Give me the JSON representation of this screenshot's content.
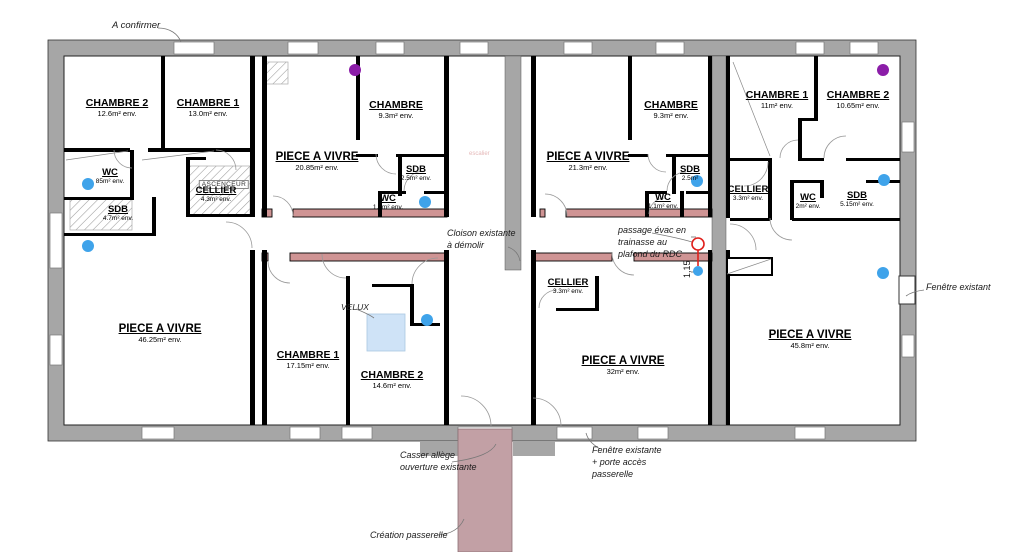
{
  "colors": {
    "wall_gray": "#a6a6a6",
    "partition_pink": "#cf9494",
    "passerelle_pink": "#c2a0a5",
    "velux_blue": "#cfe3f7",
    "dot_blue": "#3fa3ea",
    "dot_purple": "#8b1da8",
    "marker_red": "#e0201c",
    "faint_red_text": "#e5b8b8"
  },
  "rooms": [
    {
      "name": "CHAMBRE 2",
      "area": "12.6m² env."
    },
    {
      "name": "CHAMBRE 1",
      "area": "13.0m² env."
    },
    {
      "name": "WC",
      "area": "85m² env."
    },
    {
      "name": "SDB",
      "area": "4.7m² env."
    },
    {
      "name": "CELLIER",
      "area": "4.3m² env."
    },
    {
      "name": "PIECE A VIVRE",
      "area": "46.25m² env."
    },
    {
      "name": "PIECE A VIVRE",
      "area": "20.85m² env."
    },
    {
      "name": "CHAMBRE",
      "area": "9.3m² env."
    },
    {
      "name": "SDB",
      "area": "2.5m² env."
    },
    {
      "name": "WC",
      "area": "1.1m² env."
    },
    {
      "name": "CHAMBRE 1",
      "area": "17.15m² env."
    },
    {
      "name": "CHAMBRE 2",
      "area": "14.6m² env."
    },
    {
      "name": "PIECE A VIVRE",
      "area": "21.3m² env."
    },
    {
      "name": "CHAMBRE",
      "area": "9.3m² env."
    },
    {
      "name": "SDB",
      "area": "2.5m²"
    },
    {
      "name": "WC",
      "area": "1.1m² env."
    },
    {
      "name": "CELLIER",
      "area": "3.3m² env."
    },
    {
      "name": "PIECE A VIVRE",
      "area": "32m² env."
    },
    {
      "name": "CHAMBRE 1",
      "area": "11m² env."
    },
    {
      "name": "CHAMBRE 2",
      "area": "10.65m² env."
    },
    {
      "name": "CELLIER",
      "area": "3.3m² env."
    },
    {
      "name": "WC",
      "area": "2m² env."
    },
    {
      "name": "SDB",
      "area": "5.15m² env."
    },
    {
      "name": "PIECE A VIVRE",
      "area": "45.8m² env."
    }
  ],
  "annotations": {
    "a_confirmer": "A confirmer",
    "cloison": "Cloison existante\nà démolir",
    "passage_evac": "passage évac en\ntrainasse au\nplafond du RDC",
    "casser_allege": "Casser allège\nouverture existante",
    "fenetre_porte": "Fenêtre existante\n+ porte accès\npasserelle",
    "creation_passerelle": "Création passerelle",
    "fenetre_existant": "Fenêtre existant",
    "ascenseur": "ASCENCEUR",
    "velux": "VELUX",
    "escalier": "escalier",
    "dim_115": "1,15"
  }
}
